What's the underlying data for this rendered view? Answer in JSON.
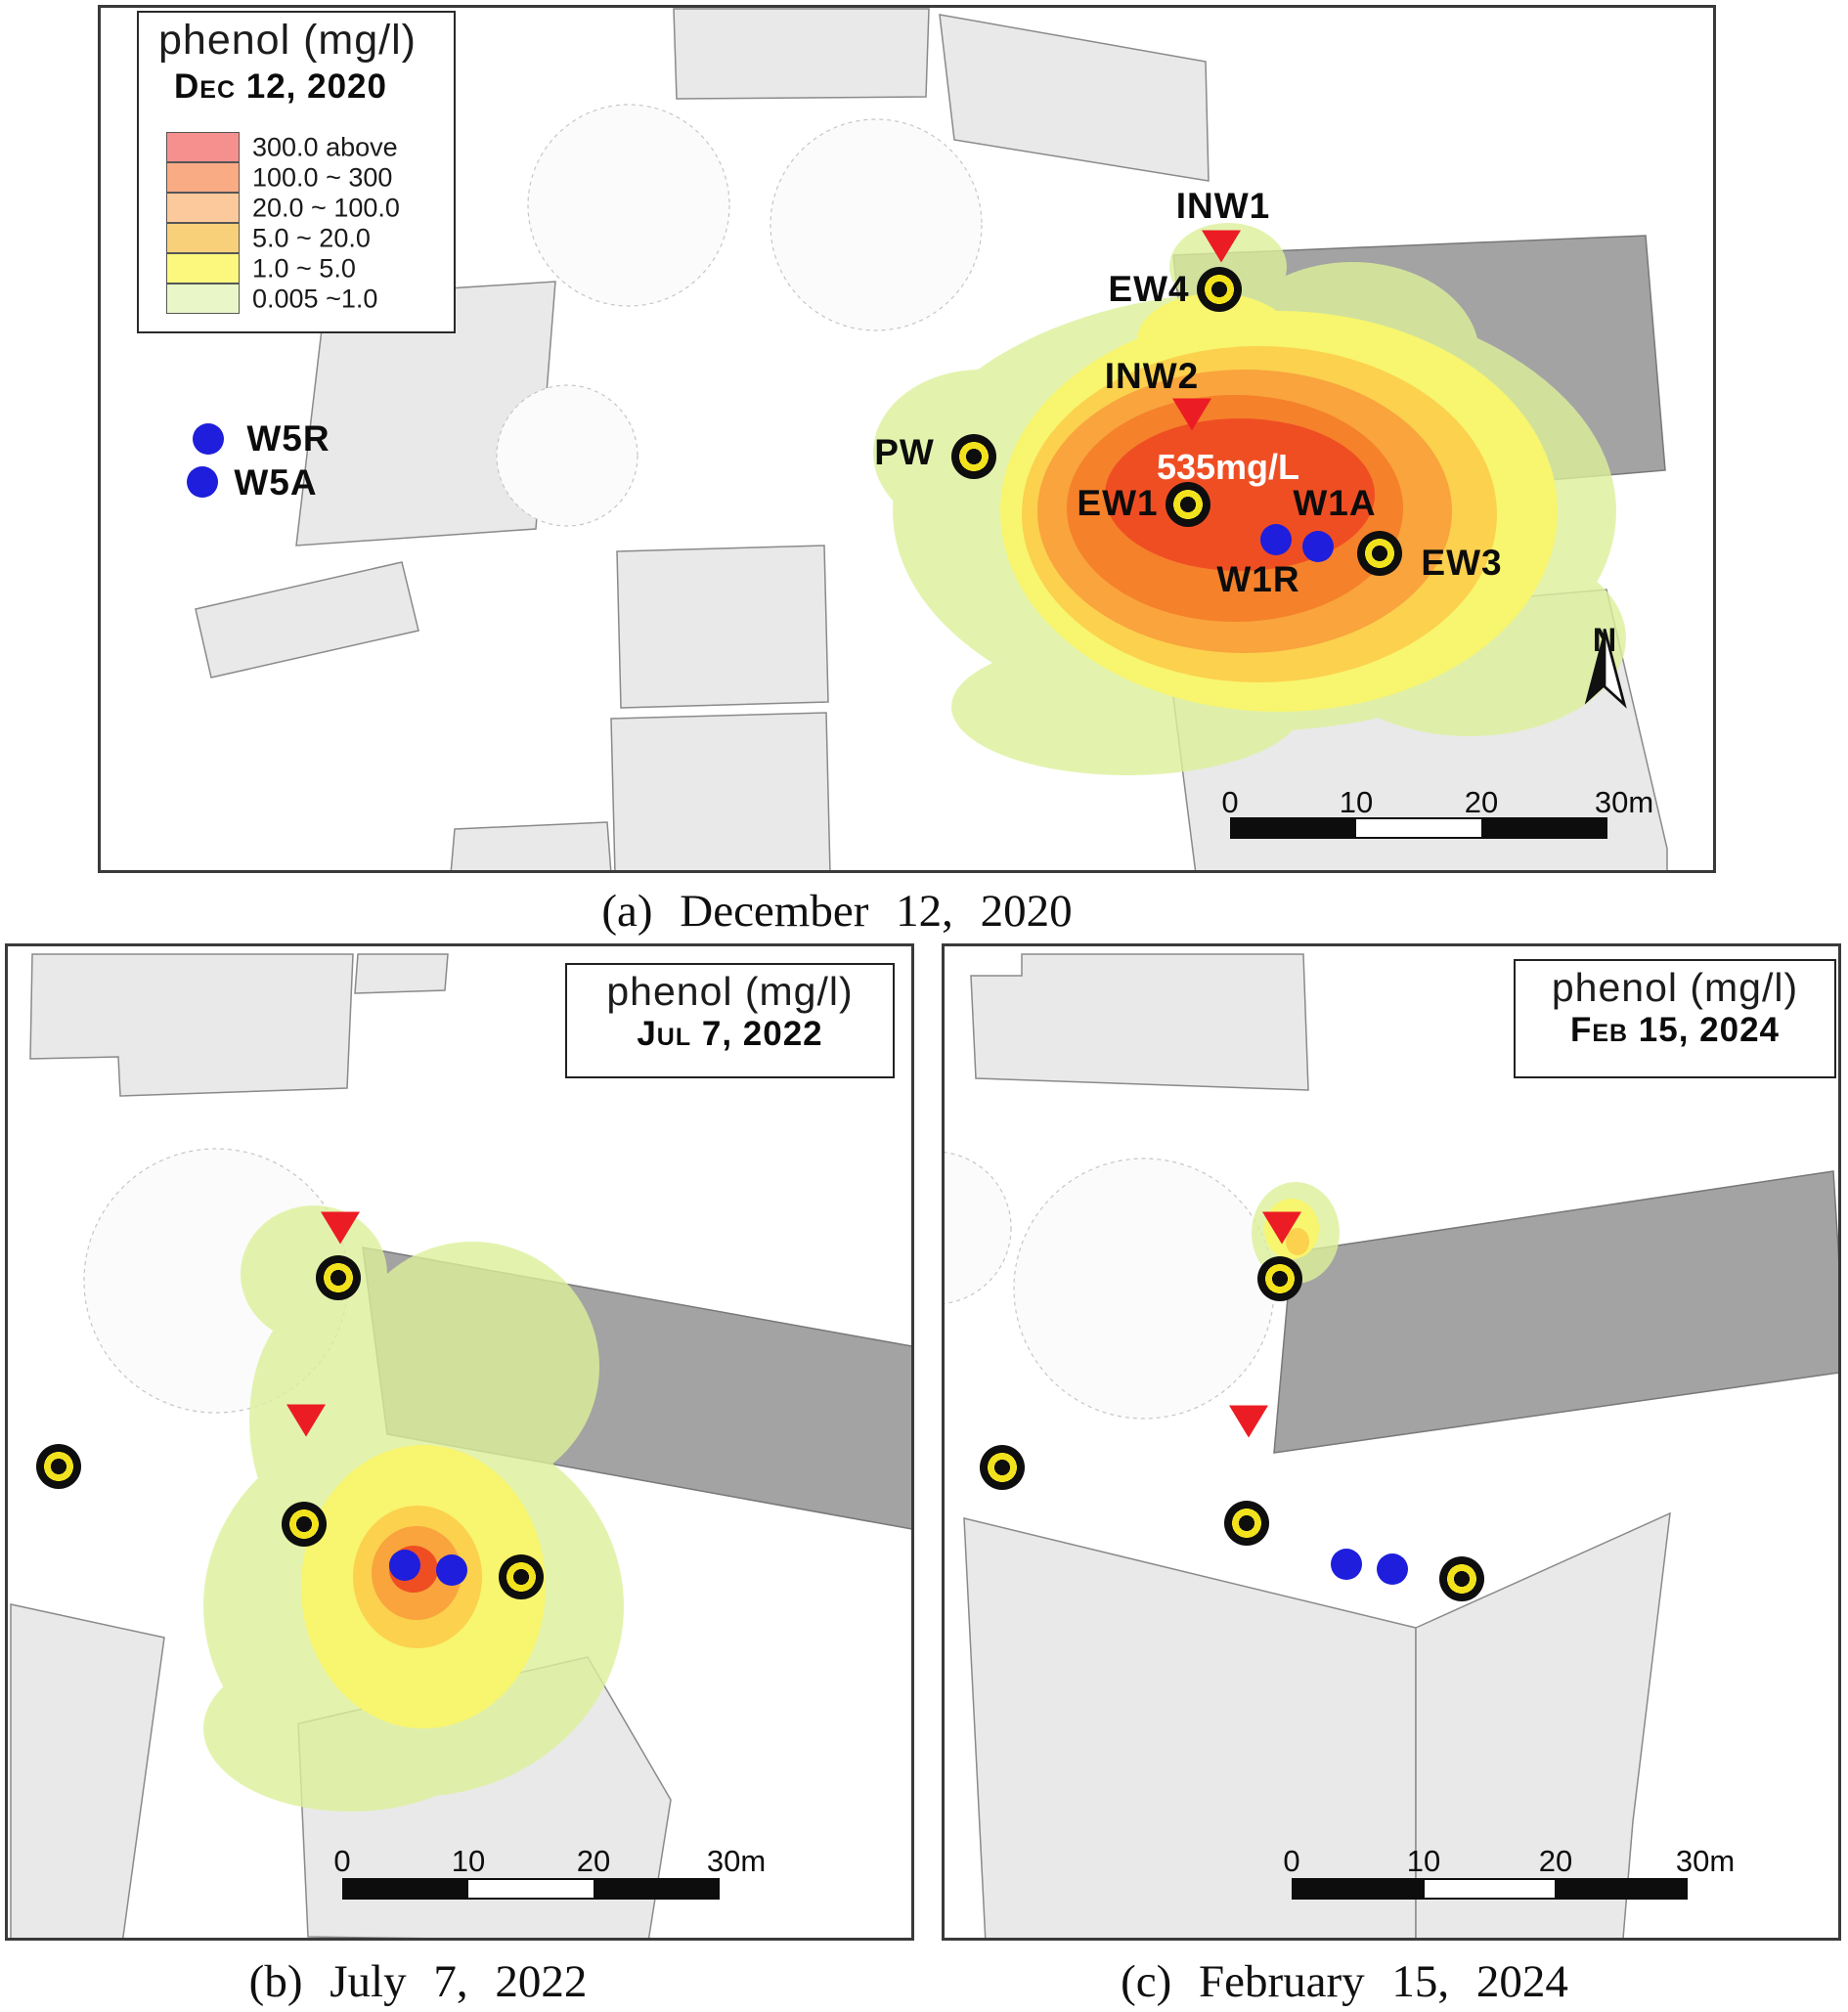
{
  "palette": {
    "plume_green": "#dcf09a",
    "plume_yellow": "#f8f56e",
    "plume_gold": "#fbd14e",
    "plume_orange": "#f9a43c",
    "plume_deep_orange": "#f5812b",
    "plume_red": "#ef4e23",
    "well_ring_yellow": "#f2e21d",
    "marker_red": "#ec1c24",
    "marker_blue": "#1e1edc",
    "building_light": "#e9e9e9",
    "building_dark": "#a3a3a3"
  },
  "panel_a": {
    "legend": {
      "title": "phenol (mg/l)",
      "date": "Dec 12, 2020",
      "items": [
        {
          "label": "300.0 above",
          "color": "#f6908e"
        },
        {
          "label": "100.0 ~ 300",
          "color": "#f9ab84"
        },
        {
          "label": "20.0 ~ 100.0",
          "color": "#fbc99b"
        },
        {
          "label": "5.0 ~ 20.0",
          "color": "#f8d07a"
        },
        {
          "label": "1.0 ~ 5.0",
          "color": "#fbf87d"
        },
        {
          "label": "0.005 ~1.0",
          "color": "#e9f7c8"
        }
      ]
    },
    "wells": {
      "w5r": "W5R",
      "w5a": "W5A",
      "pw": "PW",
      "inw1": "INW1",
      "ew4": "EW4",
      "inw2": "INW2",
      "ew1": "EW1",
      "w1a": "W1A",
      "w1r": "W1R",
      "ew3": "EW3"
    },
    "peak_annotation": "535mg/L",
    "north": "N",
    "scale": [
      "0",
      "10",
      "20",
      "30m"
    ],
    "caption": "(a) December 12, 2020"
  },
  "panel_b": {
    "title": "phenol (mg/l)",
    "date": "Jul 7, 2022",
    "scale": [
      "0",
      "10",
      "20",
      "30m"
    ],
    "caption": "(b) July 7, 2022"
  },
  "panel_c": {
    "title": "phenol (mg/l)",
    "date": "Feb 15, 2024",
    "scale": [
      "0",
      "10",
      "20",
      "30m"
    ],
    "caption": "(c) February 15, 2024"
  }
}
